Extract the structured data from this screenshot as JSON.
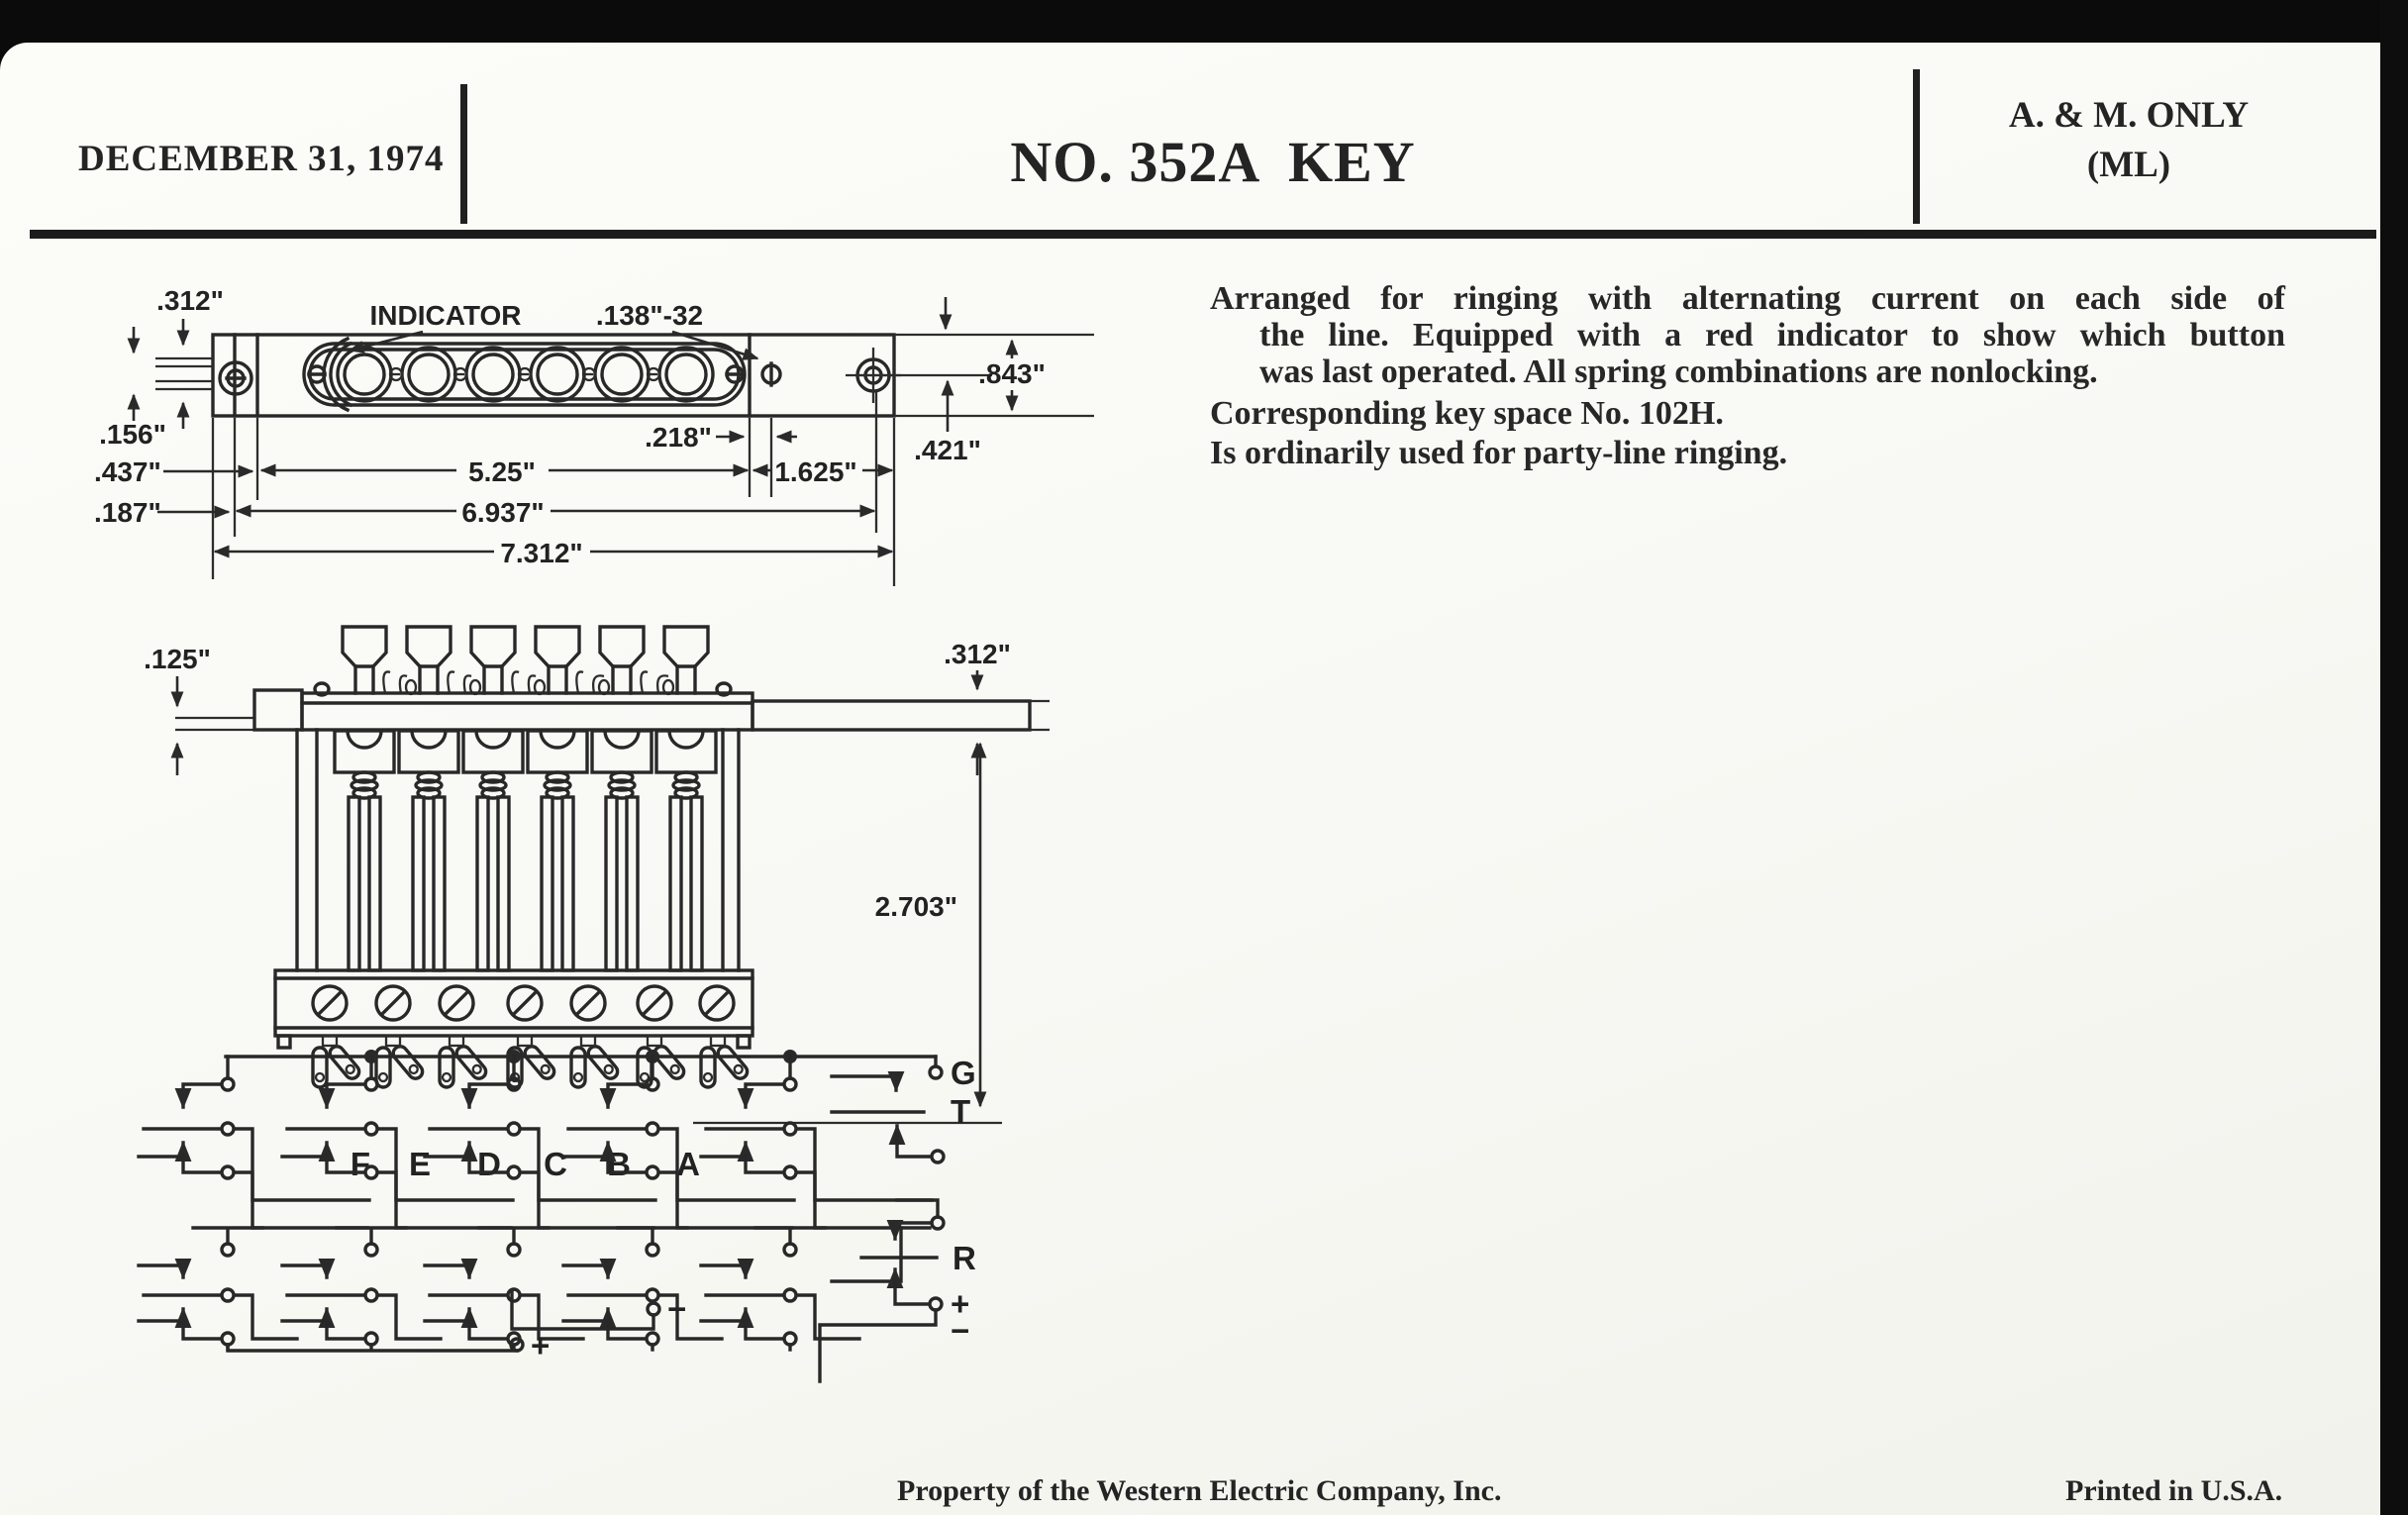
{
  "header": {
    "date": "DECEMBER 31, 1974",
    "title": "NO. 352A  KEY",
    "classification_line1": "A. & M. ONLY",
    "classification_line2": "(ML)"
  },
  "description": {
    "para1_lines": [
      "Arranged for ringing with alternating current on each side of",
      "the line. Equipped with a red indicator to show which button",
      "was last operated. All spring combinations are nonlocking."
    ],
    "para2": "Corresponding key space No. 102H.",
    "para3": "Is ordinarily used for party-line ringing."
  },
  "plan_view": {
    "labels": {
      "dim_312": ".312\"",
      "dim_156": ".156\"",
      "dim_437": ".437\"",
      "dim_187": ".187\"",
      "indicator": "INDICATOR",
      "tap": ".138\"-32",
      "dim_218": ".218\"",
      "dim_843": ".843\"",
      "dim_421": ".421\"",
      "dim_525": "5.25\"",
      "dim_1625": "1.625\"",
      "dim_6937": "6.937\"",
      "dim_7312": "7.312\""
    }
  },
  "side_view": {
    "labels": {
      "dim_125": ".125\"",
      "dim_312": ".312\"",
      "dim_2703": "2.703\""
    },
    "terminals": [
      "F",
      "E",
      "D",
      "C",
      "B",
      "A"
    ]
  },
  "schematic": {
    "terminals": {
      "ground": "G",
      "tip": "T",
      "ring": "R",
      "plus": "+",
      "minus": "−",
      "mid_plus": "+",
      "mid_minus": "−"
    }
  },
  "footer": {
    "property": "Property of the Western Electric Company, Inc.",
    "printed": "Printed in U.S.A."
  }
}
